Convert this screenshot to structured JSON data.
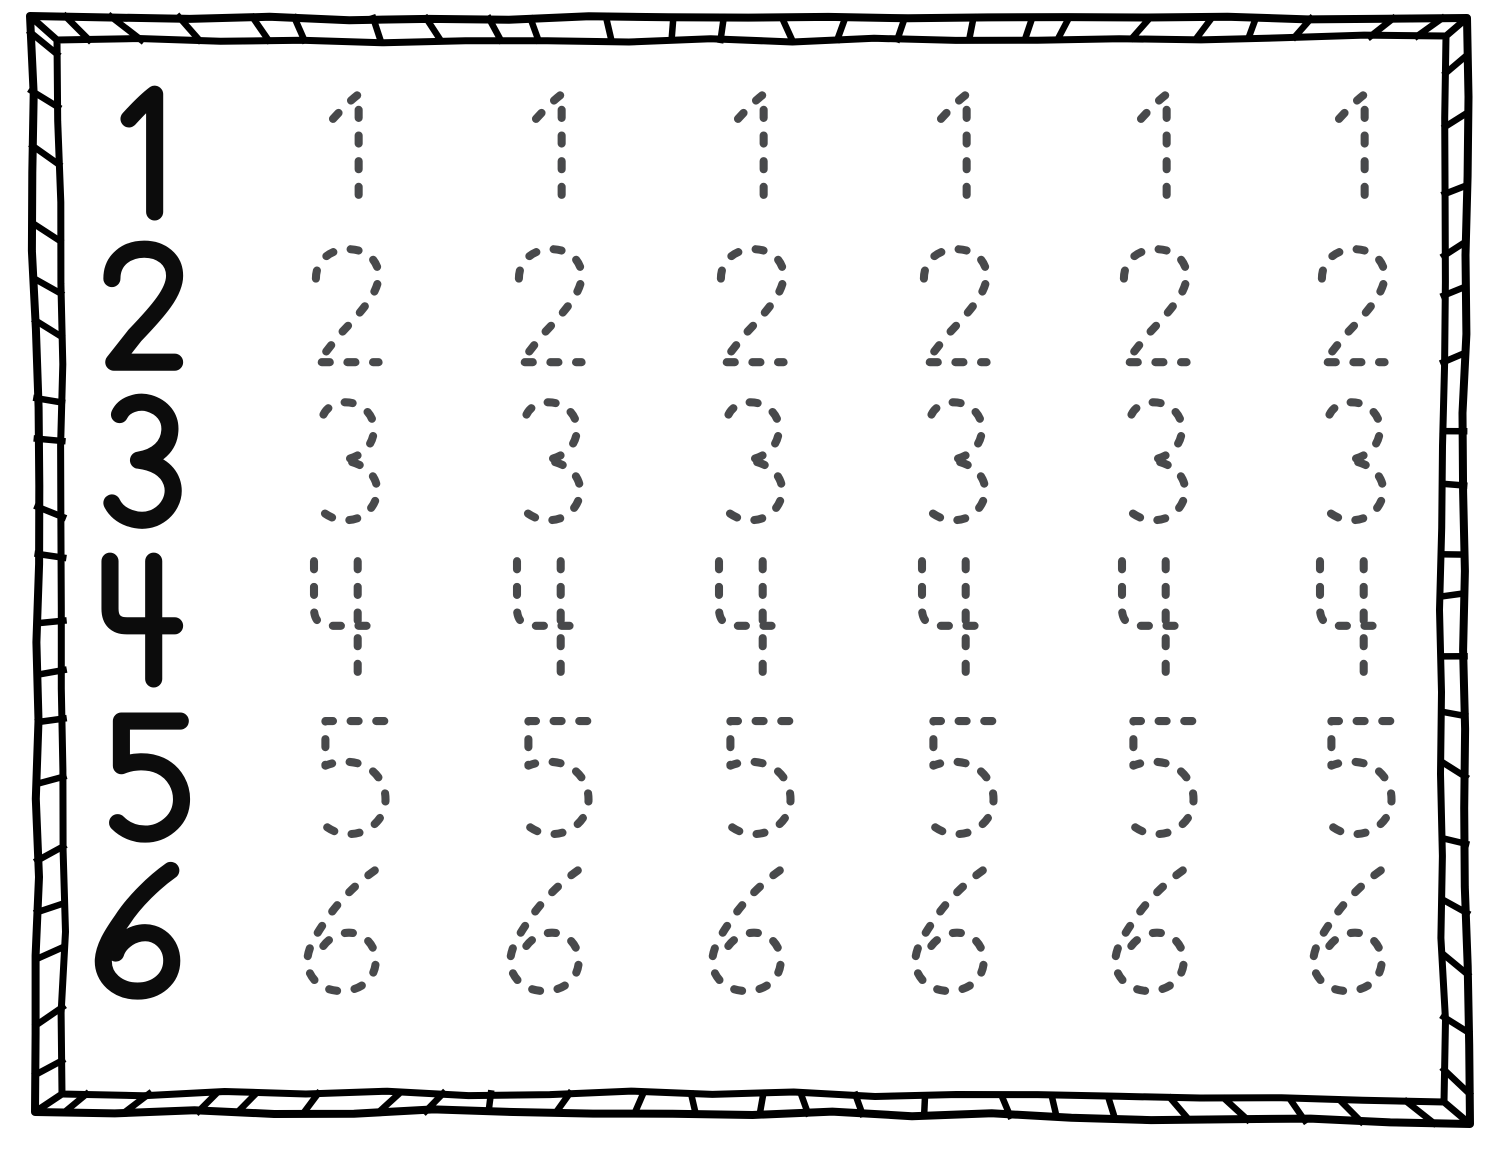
{
  "worksheet": {
    "kind": "number-tracing-worksheet",
    "digits": [
      "1",
      "2",
      "3",
      "4",
      "5",
      "6"
    ],
    "solid_examples_per_row": 1,
    "traced_copies_per_row": 6
  },
  "colors": {
    "background": "#ffffff",
    "border_ink": "#000000",
    "solid_digit_ink": "#0c0c0c",
    "traced_digit_ink": "#48494b"
  }
}
